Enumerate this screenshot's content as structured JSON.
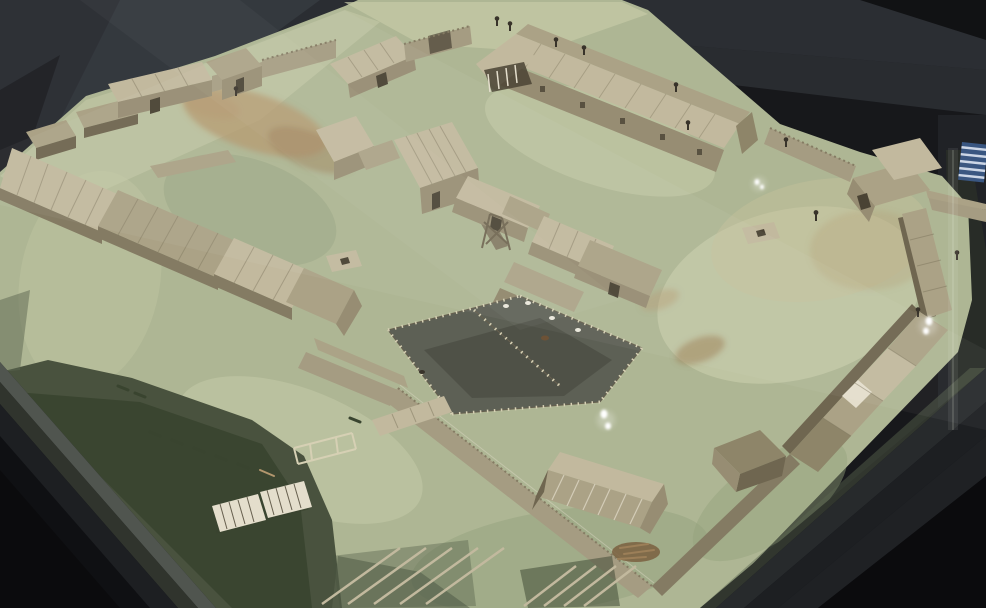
{
  "scene": {
    "type": "photograph",
    "subject": "museum scale model of a timber palisaded settlement (wooden fort) displayed inside a glass case",
    "viewpoint": "high oblique view through display-case glass",
    "visible_text_items": []
  },
  "objects": [
    "display-case-background",
    "glass-reflection-streaks",
    "case-frame-bottom-left",
    "case-frame-bottom-right",
    "model-terrain",
    "marsh-water-area",
    "dirt-paths",
    "west-longhouse-range",
    "back-left-buildings",
    "back-gate-wall",
    "great-hall-with-porch",
    "gatehouse",
    "east-wall-lean-tos",
    "southeast-building-row",
    "front-palisade",
    "central-building-cluster",
    "animal-pens-with-fences",
    "well-platforms",
    "barn",
    "woodpile",
    "outside-hut",
    "collapsed-rafter-racks",
    "duckboard-walkway",
    "fence-frame",
    "miniature-figures",
    "glare-highlights",
    "blue-screen-reflection",
    "glass-seam"
  ],
  "colors": {
    "bg_dark": "#17181b",
    "bg_streak1": "#2e3136",
    "bg_streak2": "#3b3f45",
    "bg_right": "#202226",
    "bg_darkest": "#0b0b0d",
    "case_dark": "#0f1013",
    "case_band1": "#2a2d30",
    "case_band2": "#1d1f22",
    "glass_edge": "#5c615a",
    "glass_edge2": "#343831",
    "grass": "#aeb694",
    "grass_pale": "#c6cba7",
    "grass_light": "#cdd1ae",
    "grass_dark": "#94a17d",
    "grass_tan": "#c6c19c",
    "marsh": "#49523e",
    "marsh_dark": "#39442f",
    "water_edge": "#5b6550",
    "dirt": "#b3976e",
    "dirt_dark": "#9c7f58",
    "roof_light": "#c2b99e",
    "roof_mid": "#aba286",
    "roof_dark": "#8e8569",
    "plank_line": "#7e765e",
    "wall_wood": "#978d73",
    "wall_shadow": "#6f6650",
    "palisade": "#a59c82",
    "palisade_shadow": "#847b63",
    "white_wood": "#e4decc",
    "door_dark": "#4a4334",
    "pen_ground": "#5d6055",
    "pen_dark": "#4c4f45",
    "fence_light": "#d6d0b4",
    "fence_dark": "#665f4e",
    "figure": "#38332a",
    "sheep": "#eae7db",
    "cow": "#6d5236",
    "wood_pile": "#7a5f3f",
    "glare": "#ffffff",
    "reflect_blue": "#3e5f92",
    "reflect_stripe": "#dde5f2",
    "seam": "#e9eede"
  }
}
